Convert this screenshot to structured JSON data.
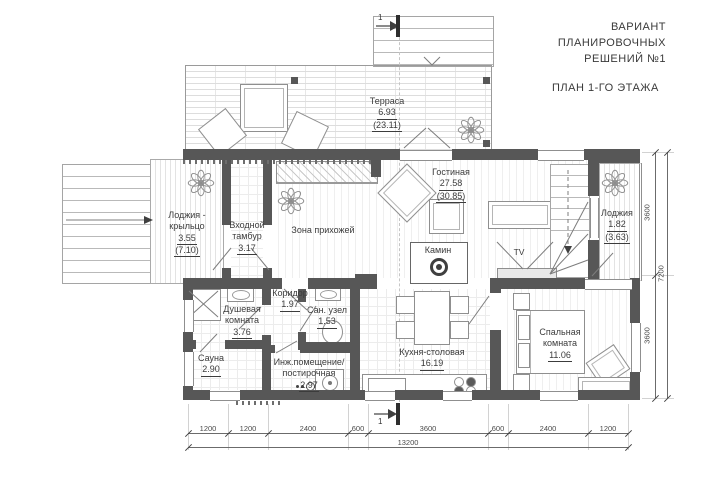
{
  "title_block": {
    "line1": "ВАРИАНТ",
    "line2": "ПЛАНИРОВОЧНЫХ",
    "line3": "РЕШЕНИЙ №1",
    "plan_title": "ПЛАН 1-ГО ЭТАЖА"
  },
  "rooms": {
    "terrace": {
      "name": "Терраса",
      "area": "6.93",
      "area_total": "(23.11)"
    },
    "loggia_porch": {
      "name": "Лоджия - крыльцо",
      "area": "3.55",
      "area_total": "(7.10)"
    },
    "vestibule": {
      "name": "Входной тамбур",
      "area": "3.17"
    },
    "hallway": {
      "name": "Зона прихожей"
    },
    "living_room": {
      "name": "Гостиная",
      "area": "27.58",
      "area_total": "(30.85)"
    },
    "loggia": {
      "name": "Лоджия",
      "area": "1.82",
      "area_total": "(3.63)"
    },
    "shower_room": {
      "name": "Душевая комната",
      "area": "3.76"
    },
    "corridor": {
      "name": "Коридор",
      "area": "1.97"
    },
    "san_uzel": {
      "name": "Сан. узел",
      "area": "1.53"
    },
    "sauna": {
      "name": "Сауна",
      "area": "2.90"
    },
    "utility": {
      "name": "Инж.помещение/ постирочная",
      "area": "2.97"
    },
    "kitchen": {
      "name": "Кухня-столовая",
      "area": "16.19"
    },
    "bedroom": {
      "name": "Спальная комната",
      "area": "11.06"
    }
  },
  "features": {
    "fireplace_label": "Камин",
    "tv_label": "TV",
    "section_mark": "1"
  },
  "dimensions": {
    "bottom_segments": [
      "1200",
      "1200",
      "2400",
      "600",
      "3600",
      "600",
      "2400",
      "1200"
    ],
    "bottom_total": "13200",
    "right_segments": [
      "3600",
      "3600"
    ],
    "right_total": "7200"
  },
  "colors": {
    "wall": "#575757",
    "line": "#8f8f8f",
    "text": "#3c3c3c"
  }
}
